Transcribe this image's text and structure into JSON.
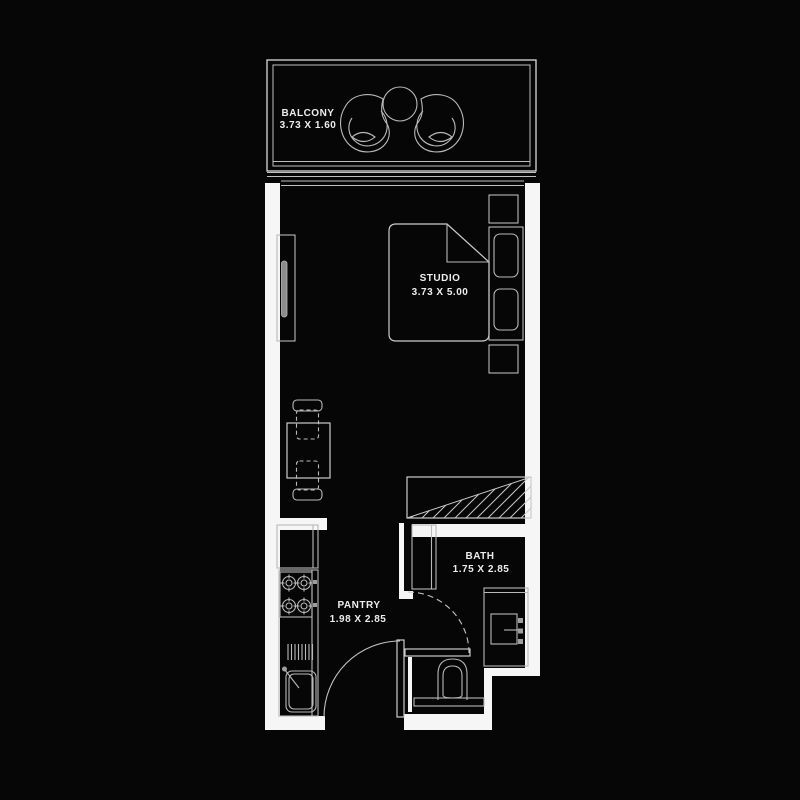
{
  "plan_title": "studio unit floor plan",
  "colors": {
    "background": "#060606",
    "wall": "#f6f6f6",
    "outline": "#d9d9d9",
    "furniture_line": "#b9b9b9",
    "text": "#ededed"
  },
  "rooms": {
    "balcony": {
      "name": "BALCONY",
      "dimensions": "3.73 X 1.60"
    },
    "studio": {
      "name": "STUDIO",
      "dimensions": "3.73 X 5.00"
    },
    "bath": {
      "name": "BATH",
      "dimensions": "1.75 X 2.85"
    },
    "pantry": {
      "name": "PANTRY",
      "dimensions": "1.98 X 2.85"
    }
  },
  "fixtures": [
    "balcony-lounge-chair-left",
    "balcony-round-table",
    "balcony-lounge-chair-right",
    "sliding-window",
    "tv-unit",
    "double-bed",
    "pillows",
    "nightstand-top",
    "nightstand-bottom",
    "dining-table",
    "dining-chairs",
    "wardrobe-hatch",
    "shower",
    "bath-door",
    "vanity-sink",
    "toilet",
    "kitchen-counter",
    "stove-hob",
    "dish-rack",
    "kitchen-sink",
    "entry-door"
  ]
}
